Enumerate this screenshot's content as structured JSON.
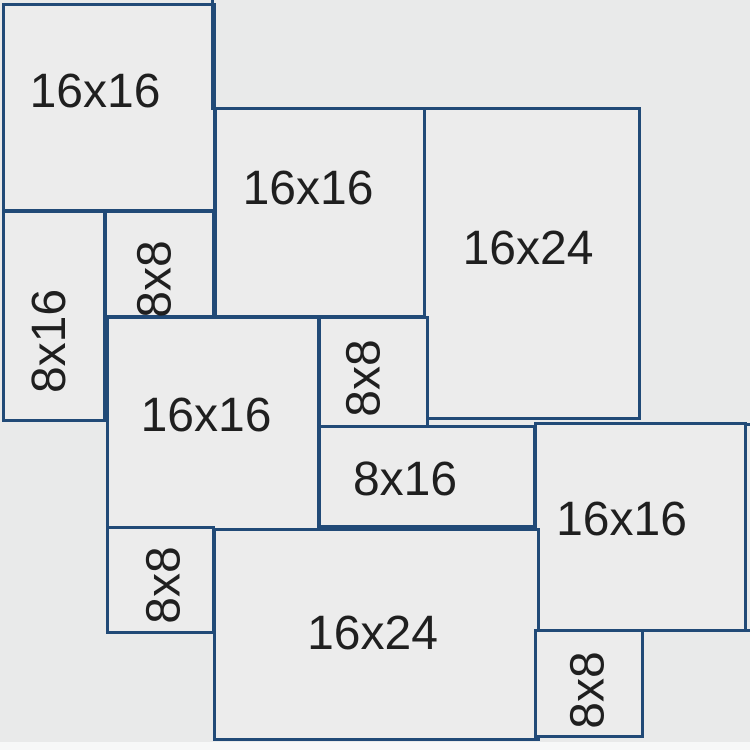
{
  "diagram": {
    "description": "Paver pattern layout diagram with labeled tile sizes",
    "colors": {
      "background": "#e9eaea",
      "tile_fill": "#ececec",
      "tile_border": "#214a77",
      "label": "#1f1f1f",
      "bottom_margin": "#f7f8f8"
    },
    "tiles": [
      {
        "id": "16x16-top-left",
        "label": "16x16",
        "vertical": false,
        "x": 2,
        "y": 3,
        "w": 214,
        "h": 209,
        "dx": -14,
        "dy": -16
      },
      {
        "id": "16x16-top-middle",
        "label": "16x16",
        "vertical": false,
        "x": 214,
        "y": 107,
        "w": 216,
        "h": 211,
        "dx": -14,
        "dy": -24
      },
      {
        "id": "16x24-upper-right",
        "label": "16x24",
        "vertical": false,
        "x": 423,
        "y": 107,
        "w": 218,
        "h": 313,
        "dx": -4,
        "dy": -15
      },
      {
        "id": "8x16-left",
        "label": "8x16",
        "vertical": true,
        "x": 2,
        "y": 210,
        "w": 104,
        "h": 212,
        "dx": -4,
        "dy": 25
      },
      {
        "id": "8x8-upper",
        "label": "8x8",
        "vertical": true,
        "x": 104,
        "y": 210,
        "w": 111,
        "h": 108,
        "dx": -4,
        "dy": 15
      },
      {
        "id": "16x16-middle",
        "label": "16x16",
        "vertical": false,
        "x": 106,
        "y": 316,
        "w": 214,
        "h": 215,
        "dx": -7,
        "dy": -8
      },
      {
        "id": "8x8-middle",
        "label": "8x8",
        "vertical": true,
        "x": 318,
        "y": 316,
        "w": 111,
        "h": 112,
        "dx": -9,
        "dy": 6
      },
      {
        "id": "8x16-middle",
        "label": "8x16",
        "vertical": false,
        "x": 318,
        "y": 425,
        "w": 218,
        "h": 103,
        "dx": -22,
        "dy": 3
      },
      {
        "id": "16x16-right",
        "label": "16x16",
        "vertical": false,
        "x": 534,
        "y": 422,
        "w": 213,
        "h": 210,
        "dx": -19,
        "dy": -7
      },
      {
        "id": "8x8-lower-left",
        "label": "8x8",
        "vertical": true,
        "x": 106,
        "y": 526,
        "w": 109,
        "h": 108,
        "dx": 4,
        "dy": 5
      },
      {
        "id": "16x24-bottom",
        "label": "16x24",
        "vertical": false,
        "x": 213,
        "y": 528,
        "w": 327,
        "h": 213,
        "dx": -4,
        "dy": -1
      },
      {
        "id": "8x8-bottom-right",
        "label": "8x8",
        "vertical": true,
        "x": 534,
        "y": 629,
        "w": 110,
        "h": 109,
        "dx": 0,
        "dy": 6
      }
    ],
    "edge_lines": [
      {
        "id": "top-edge-extension",
        "x": 211,
        "y": 0,
        "w": 3,
        "h": 110
      },
      {
        "id": "right-edge-extension-upper",
        "x": 747,
        "y": 423,
        "w": 3,
        "h": 3
      },
      {
        "id": "right-edge-extension-lower",
        "x": 747,
        "y": 629,
        "w": 3,
        "h": 3
      }
    ]
  }
}
